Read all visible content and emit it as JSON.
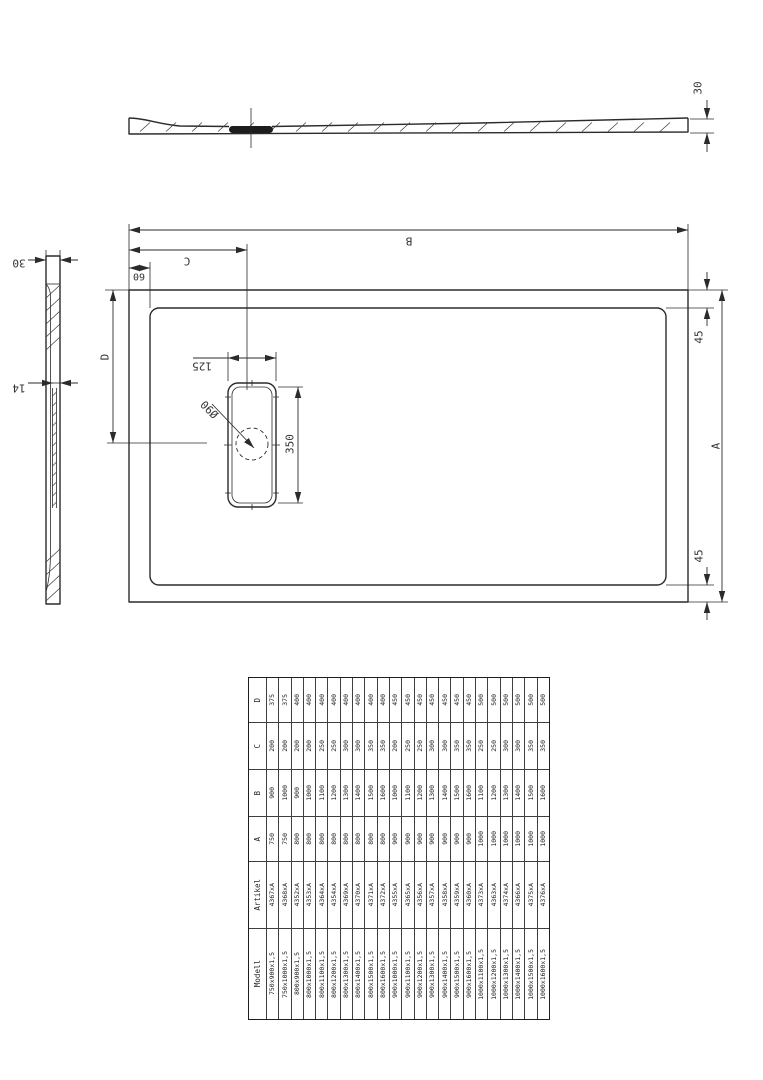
{
  "drawing": {
    "dim_labels": {
      "profile_height": "30",
      "side_height": "30",
      "side_wall": "14",
      "plan_length": "B",
      "drain_offset_x": "C",
      "edge_offset": "60",
      "drain_offset_y": "D",
      "plan_width": "A",
      "corner_top": "45",
      "corner_bottom": "45",
      "drain_length": "350",
      "drain_width": "125",
      "drain_diameter": "Ø90"
    }
  },
  "table": {
    "headers": [
      "D",
      "C",
      "B",
      "A",
      "Artikel",
      "Modell"
    ],
    "rows": [
      {
        "modell": "750x900x1,5",
        "artikel": "4367xA",
        "a": "750",
        "b": "900",
        "c": "200",
        "d": "375"
      },
      {
        "modell": "750x1000x1,5",
        "artikel": "4368xA",
        "a": "750",
        "b": "1000",
        "c": "200",
        "d": "375"
      },
      {
        "modell": "800x900x1,5",
        "artikel": "4352xA",
        "a": "800",
        "b": "900",
        "c": "200",
        "d": "400"
      },
      {
        "modell": "800x1000x1,5",
        "artikel": "4353xA",
        "a": "800",
        "b": "1000",
        "c": "200",
        "d": "400"
      },
      {
        "modell": "800x1100x1,5",
        "artikel": "4364xA",
        "a": "800",
        "b": "1100",
        "c": "250",
        "d": "400"
      },
      {
        "modell": "800x1200x1,5",
        "artikel": "4354xA",
        "a": "800",
        "b": "1200",
        "c": "250",
        "d": "400"
      },
      {
        "modell": "800x1300x1,5",
        "artikel": "4369xA",
        "a": "800",
        "b": "1300",
        "c": "300",
        "d": "400"
      },
      {
        "modell": "800x1400x1,5",
        "artikel": "4370xA",
        "a": "800",
        "b": "1400",
        "c": "300",
        "d": "400"
      },
      {
        "modell": "800x1500x1,5",
        "artikel": "4371xA",
        "a": "800",
        "b": "1500",
        "c": "350",
        "d": "400"
      },
      {
        "modell": "800x1600x1,5",
        "artikel": "4372xA",
        "a": "800",
        "b": "1600",
        "c": "350",
        "d": "400"
      },
      {
        "modell": "900x1000x1,5",
        "artikel": "4355xA",
        "a": "900",
        "b": "1000",
        "c": "200",
        "d": "450"
      },
      {
        "modell": "900x1100x1,5",
        "artikel": "4365xA",
        "a": "900",
        "b": "1100",
        "c": "250",
        "d": "450"
      },
      {
        "modell": "900x1200x1,5",
        "artikel": "4356xA",
        "a": "900",
        "b": "1200",
        "c": "250",
        "d": "450"
      },
      {
        "modell": "900x1300x1,5",
        "artikel": "4357xA",
        "a": "900",
        "b": "1300",
        "c": "300",
        "d": "450"
      },
      {
        "modell": "900x1400x1,5",
        "artikel": "4358xA",
        "a": "900",
        "b": "1400",
        "c": "300",
        "d": "450"
      },
      {
        "modell": "900x1500x1,5",
        "artikel": "4359xA",
        "a": "900",
        "b": "1500",
        "c": "350",
        "d": "450"
      },
      {
        "modell": "900x1600x1,5",
        "artikel": "4360xA",
        "a": "900",
        "b": "1600",
        "c": "350",
        "d": "450"
      },
      {
        "modell": "1000x1100x1,5",
        "artikel": "4373xA",
        "a": "1000",
        "b": "1100",
        "c": "250",
        "d": "500"
      },
      {
        "modell": "1000x1200x1,5",
        "artikel": "4363xA",
        "a": "1000",
        "b": "1200",
        "c": "250",
        "d": "500"
      },
      {
        "modell": "1000x1300x1,5",
        "artikel": "4374xA",
        "a": "1000",
        "b": "1300",
        "c": "300",
        "d": "500"
      },
      {
        "modell": "1000x1400x1,5",
        "artikel": "4366xA",
        "a": "1000",
        "b": "1400",
        "c": "300",
        "d": "500"
      },
      {
        "modell": "1000x1500x1,5",
        "artikel": "4375xA",
        "a": "1000",
        "b": "1500",
        "c": "350",
        "d": "500"
      },
      {
        "modell": "1000x1600x1,5",
        "artikel": "4376xA",
        "a": "1000",
        "b": "1600",
        "c": "350",
        "d": "500"
      }
    ]
  }
}
